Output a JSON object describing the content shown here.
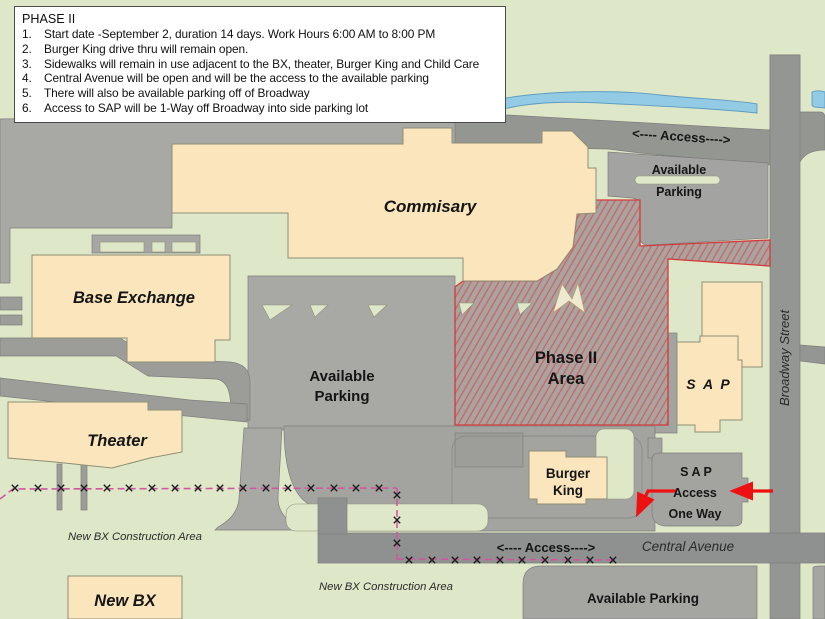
{
  "notes": {
    "title": "PHASE II",
    "items": [
      {
        "num": "1.",
        "text": "Start date -September 2, duration 14 days. Work Hours 6:00 AM to 8:00 PM"
      },
      {
        "num": "2.",
        "text": "Burger King drive thru will remain open."
      },
      {
        "num": "3.",
        "text": "Sidewalks will remain in use adjacent to the BX, theater, Burger King and Child Care"
      },
      {
        "num": "4.",
        "text": "Central Avenue will be open and will be the access to the available parking"
      },
      {
        "num": "5.",
        "text": "There will also be available parking off of Broadway"
      },
      {
        "num": "6.",
        "text": "Access to SAP will be 1-Way off Broadway into side parking lot"
      }
    ]
  },
  "labels": {
    "commissary": "Commisary",
    "base_exchange": "Base Exchange",
    "theater": "Theater",
    "new_bx": "New BX",
    "sap_building": "S A P",
    "burger_king": [
      "Burger",
      "King"
    ],
    "phase2": [
      "Phase II",
      "Area"
    ],
    "available_parking": [
      "Available",
      "Parking"
    ],
    "available_parking_bottom": "Available Parking",
    "access_top": "<---- Access---->",
    "access_bottom": "<---- Access---->",
    "sap_access": [
      "S A P",
      "Access",
      "One Way"
    ],
    "broadway": "Broadway Street",
    "central_avenue": "Central Avenue",
    "construction_area_left": "New BX Construction Area",
    "construction_area_right": "New BX Construction Area"
  },
  "colors": {
    "background_green": "#dfe7c9",
    "parking_gray": "#a8a8a5",
    "road_gray": "#8f9190",
    "building_cream": "#fae5bd",
    "building_olive": "#d8d2a0",
    "water_blue": "#92cbe3",
    "phase2_hatch_red": "#dd5a5a",
    "phase2_border_red": "#d23b3b",
    "fence_pink": "#d157a0",
    "arrow_red": "#ee1111",
    "burger_king_text": "#cc2200"
  }
}
